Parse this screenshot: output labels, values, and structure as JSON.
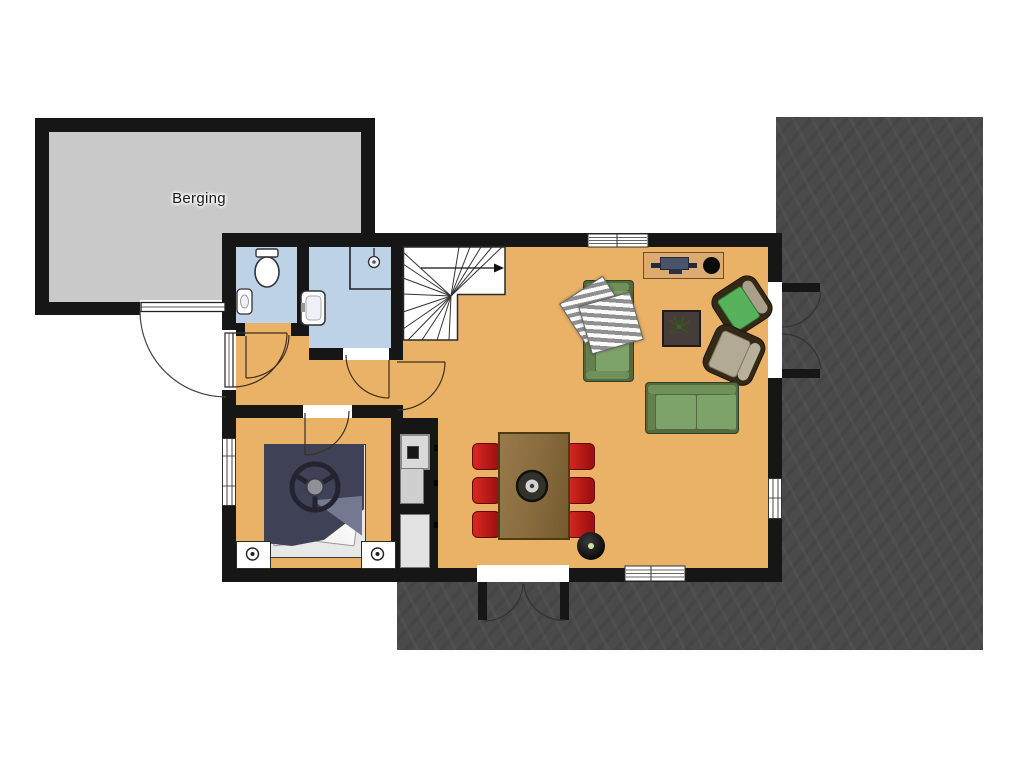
{
  "labels": {
    "berging": "Berging"
  },
  "colors": {
    "wall": "#161616",
    "outside": "#ffffff",
    "berging_floor": "#c9c9c9",
    "terrace_floor": "#4a4a4a",
    "house_floor": "#e9b266",
    "wet_floor": "#bdd2e7",
    "sofa_green": "#7ea36a",
    "sofa_frame": "#55693f",
    "armchair_frame": "#342817",
    "armchair_green": "#58b25c",
    "armchair_tan": "#b3aa95",
    "table_brown": "#8b6e40",
    "chair_red": "#c01a1a",
    "bed_navy": "#3f4156",
    "sideboard_tan": "#dcab72",
    "appliance_gray": "#d9d9d9",
    "stripe_blanket_gray": "#8f8f8f"
  },
  "rooms": [
    {
      "name": "berging",
      "floor": "gray"
    },
    {
      "name": "toilet",
      "floor": "blue"
    },
    {
      "name": "bathroom",
      "floor": "blue"
    },
    {
      "name": "hallway",
      "floor": "orange"
    },
    {
      "name": "bedroom",
      "floor": "orange"
    },
    {
      "name": "living-dining-kitchen",
      "floor": "orange"
    },
    {
      "name": "terrace",
      "floor": "dark-gray"
    }
  ],
  "fixtures": [
    "staircase",
    "stair-direction-arrow",
    "toilet",
    "hand-basin",
    "washbasin",
    "shower"
  ],
  "furniture": [
    "double-bed",
    "nightstand",
    "nightstand",
    "kitchen-counter",
    "oven",
    "dining-table",
    "dining-chair-x6",
    "table-centerpiece",
    "floor-lamp",
    "sideboard",
    "tv",
    "speaker",
    "sofa-vertical",
    "sofa-horizontal",
    "throw-blankets",
    "coffee-table",
    "plant",
    "armchair-green",
    "armchair-tan"
  ],
  "doors": [
    "berging-exterior-door",
    "front-door",
    "toilet-door",
    "bathroom-door",
    "bedroom-door",
    "hall-living-door",
    "french-doors-east",
    "french-doors-south"
  ],
  "windows": [
    "bedroom-window-west",
    "living-window-north",
    "living-window-south",
    "living-window-east"
  ]
}
